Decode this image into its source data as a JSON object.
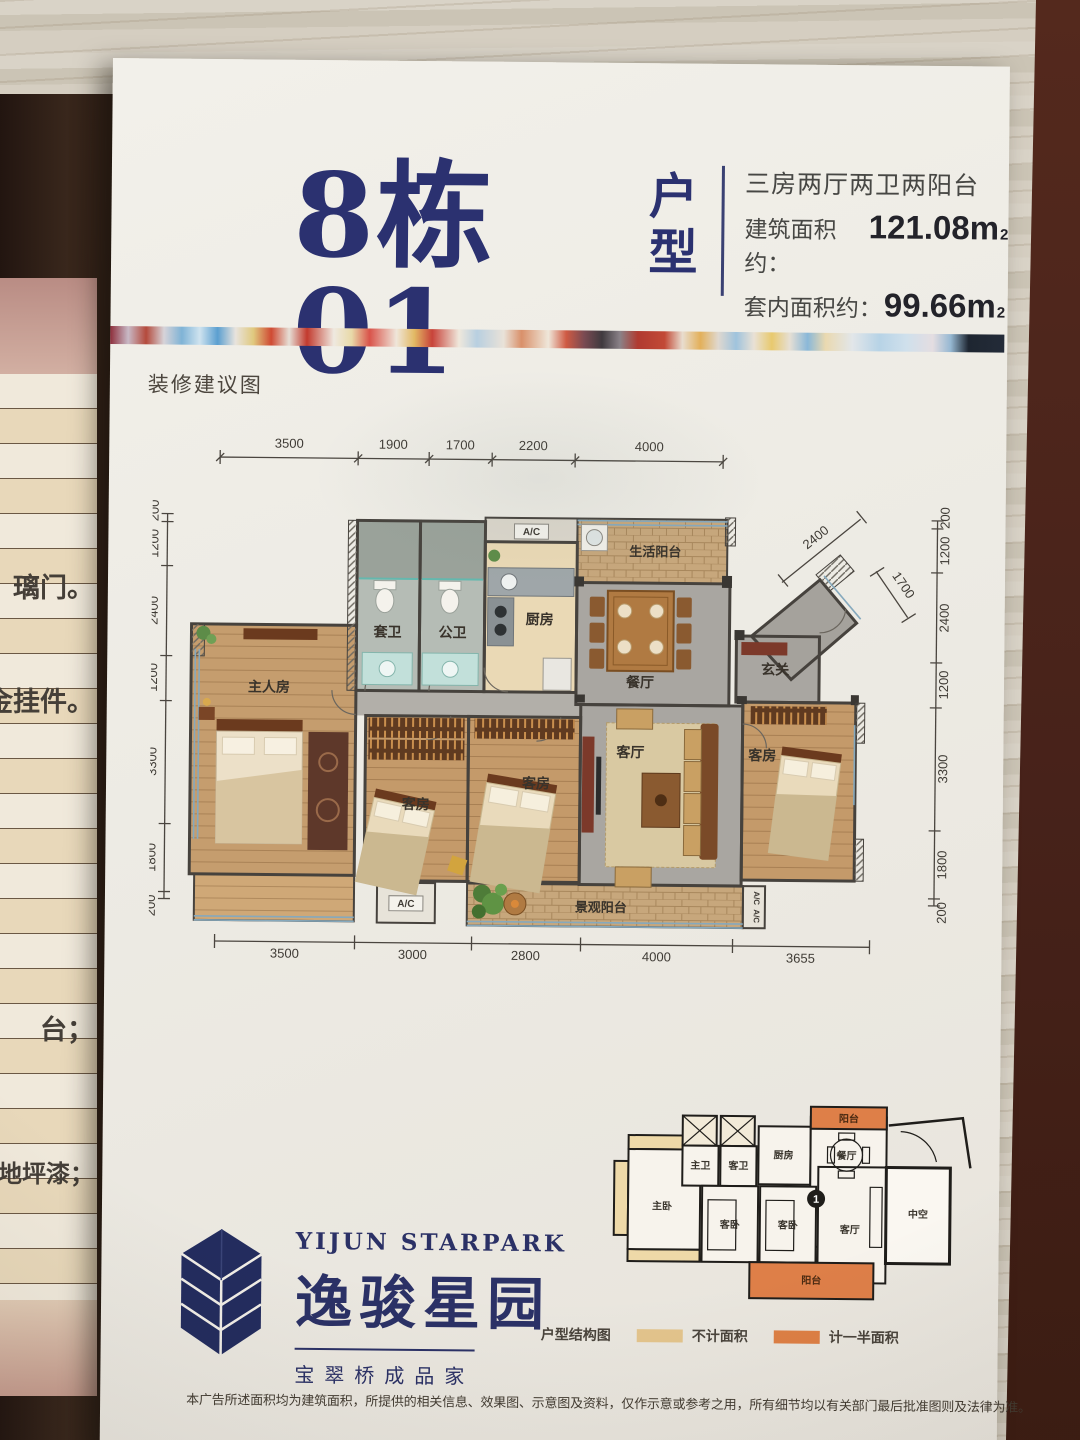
{
  "poster": {
    "title_main": "8栋01",
    "title_suffix": [
      "户",
      "型"
    ],
    "spec_line1": "三房两厅两卫两阳台",
    "spec_area_label": "建筑面积约：",
    "spec_area_value": "121.08m",
    "spec_area_sup": "2",
    "spec_inner_label": "套内面积约：",
    "spec_inner_value": "99.66m",
    "spec_inner_sup": "2",
    "section_label": "装修建议图",
    "disclaimer": "本广告所述面积均为建筑面积，所提供的相关信息、效果图、示意图及资料，仅作示意或参考之用，所有细节均以有关部门最后批准图则及法律为准。"
  },
  "plan": {
    "dims_top": [
      "3500",
      "1900",
      "1700",
      "2200",
      "4000"
    ],
    "dims_bottom": [
      "3500",
      "3000",
      "2800",
      "4000",
      "3655"
    ],
    "dims_left": [
      "200",
      "1200",
      "2400",
      "1200",
      "3300",
      "1800",
      "200"
    ],
    "dims_right": [
      "200",
      "1200",
      "2400",
      "1200",
      "3300",
      "1800",
      "200"
    ],
    "dim_diag_a": "2400",
    "dim_diag_b": "1700",
    "rooms": {
      "master": "主人房",
      "guest": "客房",
      "living": "客厅",
      "dining": "餐厅",
      "kitchen": "厨房",
      "ensuite_bath": "套卫",
      "public_bath": "公卫",
      "foyer": "玄关",
      "service_balcony": "生活阳台",
      "view_balcony": "景观阳台",
      "ac": "A/C"
    }
  },
  "logo": {
    "en": "YIJUN STARPARK",
    "cn": "逸骏星园",
    "tagline": "宝翠桥成品家"
  },
  "inset": {
    "legend_title": "户型结构图",
    "legend_excluded": "不计面积",
    "legend_half": "计一半面积",
    "unit_number": "1",
    "rooms": {
      "balcony": "阳台",
      "master": "主卧",
      "guest": "客卧",
      "living": "客厅",
      "void": "中空",
      "kitchen": "厨房",
      "master_bath": "主卫",
      "guest_bath": "客卫",
      "dining": "餐厅"
    }
  },
  "left_panel": {
    "fragments": [
      "璃门。",
      "金挂件。",
      "台；",
      "地坪漆；"
    ]
  },
  "colors": {
    "title_navy": "#2b3170",
    "balcony_orange": "#e07f4a",
    "legend_tan": "#e3c48c",
    "legend_orange": "#dd7f45",
    "stripe_end_navy": "#232b38"
  }
}
